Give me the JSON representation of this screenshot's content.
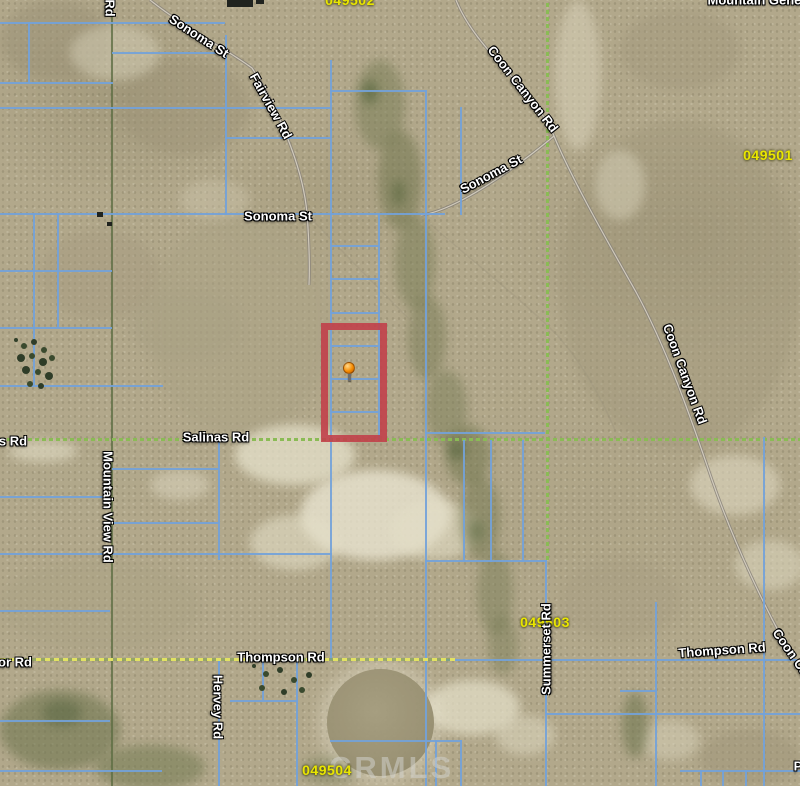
{
  "map": {
    "watermark_text": "CRMLS",
    "colors": {
      "terrain_base": "#b2a88b",
      "parcel_line_blue": "#73a2d9",
      "section_line_green": "#8abb55",
      "road_dash_yellow": "#e2e263",
      "highlight_red": "#c2414b",
      "marker_orange": "#f68b00",
      "parcel_label_yellow": "#e9e600",
      "road_label_white": "#ffffff",
      "watermark_gray": "#d0d0ca"
    }
  },
  "marker": {
    "x": 349,
    "y": 368
  },
  "highlight_parcel": {
    "x": 321,
    "y": 323,
    "w": 66,
    "h": 119
  },
  "labels": [
    {
      "name": "area-label-049502-partial",
      "kind": "parcel",
      "text": "049502",
      "x": 350,
      "y": 0,
      "rot": 0
    },
    {
      "name": "area-label-049501",
      "kind": "parcel",
      "text": "049501",
      "x": 768,
      "y": 155,
      "rot": 0
    },
    {
      "name": "area-label-049503",
      "kind": "parcel",
      "text": "049503",
      "x": 545,
      "y": 622,
      "rot": 0
    },
    {
      "name": "area-label-049504",
      "kind": "parcel",
      "text": "049504",
      "x": 327,
      "y": 770,
      "rot": 0
    },
    {
      "name": "road-label-sonoma-st-nw",
      "kind": "road",
      "text": "Sonoma St",
      "x": 199,
      "y": 36,
      "rot": 33
    },
    {
      "name": "road-label-fairview-rd",
      "kind": "road",
      "text": "Fairview Rd",
      "x": 271,
      "y": 106,
      "rot": 61
    },
    {
      "name": "road-label-coon-canyon-rd-n",
      "kind": "road",
      "text": "Coon Canyon Rd",
      "x": 523,
      "y": 89,
      "rot": 52
    },
    {
      "name": "road-label-sonoma-st-mid",
      "kind": "road",
      "text": "Sonoma St",
      "x": 491,
      "y": 174,
      "rot": -28
    },
    {
      "name": "road-label-sonoma-st-w",
      "kind": "road",
      "text": "Sonoma St",
      "x": 278,
      "y": 216,
      "rot": 0
    },
    {
      "name": "road-label-salinas-rd",
      "kind": "road",
      "text": "Salinas Rd",
      "x": 216,
      "y": 437,
      "rot": 0
    },
    {
      "name": "road-label-mountain-view-rd",
      "kind": "road",
      "text": "Mountain View Rd",
      "x": 108,
      "y": 507,
      "rot": 90
    },
    {
      "name": "road-label-coon-canyon-rd-s",
      "kind": "road",
      "text": "Coon Canyon Rd",
      "x": 685,
      "y": 374,
      "rot": 70
    },
    {
      "name": "road-label-summerset-rd",
      "kind": "road",
      "text": "Summerset Rd",
      "x": 546,
      "y": 649,
      "rot": -90
    },
    {
      "name": "road-label-thompson-rd-w",
      "kind": "road",
      "text": "Thompson Rd",
      "x": 281,
      "y": 657,
      "rot": 0
    },
    {
      "name": "road-label-thompson-rd-e",
      "kind": "road",
      "text": "Thompson Rd",
      "x": 722,
      "y": 650,
      "rot": -4
    },
    {
      "name": "road-label-coon-canyon-rd-se-partial",
      "kind": "road",
      "text": "Coon Ca",
      "x": 791,
      "y": 652,
      "rot": 55
    },
    {
      "name": "road-label-hervey-rd",
      "kind": "road",
      "text": "Hervey Rd",
      "x": 218,
      "y": 707,
      "rot": 90
    },
    {
      "name": "road-label-rd-partial-top",
      "kind": "road",
      "text": "Rd",
      "x": 110,
      "y": 8,
      "rot": 90
    },
    {
      "name": "road-label-s-rd-partial",
      "kind": "road",
      "text": "s Rd",
      "x": 13,
      "y": 441,
      "rot": 0
    },
    {
      "name": "road-label-or-rd-partial",
      "kind": "road",
      "text": "or Rd",
      "x": 15,
      "y": 662,
      "rot": 0
    },
    {
      "name": "road-label-mountain-gener-partial",
      "kind": "road",
      "text": "Mountain Gener",
      "x": 757,
      "y": 0,
      "rot": 0
    },
    {
      "name": "road-label-p-partial",
      "kind": "road",
      "text": "P",
      "x": 798,
      "y": 766,
      "rot": 0
    }
  ],
  "map_lines": [
    {
      "x": 111,
      "y": 0,
      "w": 2,
      "h": 786,
      "t": "olive"
    },
    {
      "x": 0,
      "y": 438,
      "w": 800,
      "h": 3,
      "t": "section"
    },
    {
      "x": 546,
      "y": 0,
      "w": 3,
      "h": 560,
      "t": "section"
    },
    {
      "x": 0,
      "y": 22,
      "w": 225,
      "h": 2
    },
    {
      "x": 112,
      "y": 52,
      "w": 113,
      "h": 2
    },
    {
      "x": 0,
      "y": 82,
      "w": 113,
      "h": 2
    },
    {
      "x": 0,
      "y": 107,
      "w": 330,
      "h": 2
    },
    {
      "x": 225,
      "y": 137,
      "w": 105,
      "h": 2
    },
    {
      "x": 330,
      "y": 90,
      "w": 97,
      "h": 2
    },
    {
      "x": 0,
      "y": 213,
      "w": 445,
      "h": 2
    },
    {
      "x": 0,
      "y": 270,
      "w": 112,
      "h": 2
    },
    {
      "x": 0,
      "y": 327,
      "w": 112,
      "h": 2
    },
    {
      "x": 0,
      "y": 385,
      "w": 163,
      "h": 2
    },
    {
      "x": 330,
      "y": 245,
      "w": 48,
      "h": 2
    },
    {
      "x": 330,
      "y": 278,
      "w": 48,
      "h": 2
    },
    {
      "x": 330,
      "y": 312,
      "w": 48,
      "h": 2
    },
    {
      "x": 330,
      "y": 345,
      "w": 48,
      "h": 2
    },
    {
      "x": 330,
      "y": 378,
      "w": 48,
      "h": 2
    },
    {
      "x": 330,
      "y": 411,
      "w": 48,
      "h": 2
    },
    {
      "x": 0,
      "y": 496,
      "w": 110,
      "h": 2
    },
    {
      "x": 112,
      "y": 468,
      "w": 106,
      "h": 2
    },
    {
      "x": 112,
      "y": 522,
      "w": 106,
      "h": 2
    },
    {
      "x": 0,
      "y": 553,
      "w": 332,
      "h": 2
    },
    {
      "x": 0,
      "y": 610,
      "w": 110,
      "h": 2
    },
    {
      "x": 425,
      "y": 432,
      "w": 120,
      "h": 2
    },
    {
      "x": 425,
      "y": 560,
      "w": 122,
      "h": 2
    },
    {
      "x": 440,
      "y": 659,
      "w": 360,
      "h": 2
    },
    {
      "x": 0,
      "y": 720,
      "w": 110,
      "h": 2
    },
    {
      "x": 230,
      "y": 700,
      "w": 68,
      "h": 2
    },
    {
      "x": 545,
      "y": 713,
      "w": 255,
      "h": 2
    },
    {
      "x": 620,
      "y": 690,
      "w": 37,
      "h": 2
    },
    {
      "x": 680,
      "y": 770,
      "w": 120,
      "h": 2
    },
    {
      "x": 0,
      "y": 770,
      "w": 162,
      "h": 2
    },
    {
      "x": 330,
      "y": 740,
      "w": 132,
      "h": 2
    },
    {
      "x": 28,
      "y": 22,
      "w": 2,
      "h": 60
    },
    {
      "x": 33,
      "y": 213,
      "w": 2,
      "h": 172
    },
    {
      "x": 57,
      "y": 213,
      "w": 2,
      "h": 114
    },
    {
      "x": 225,
      "y": 35,
      "w": 2,
      "h": 180
    },
    {
      "x": 330,
      "y": 60,
      "w": 2,
      "h": 600
    },
    {
      "x": 378,
      "y": 213,
      "w": 2,
      "h": 227
    },
    {
      "x": 425,
      "y": 90,
      "w": 2,
      "h": 696
    },
    {
      "x": 460,
      "y": 107,
      "w": 2,
      "h": 108
    },
    {
      "x": 463,
      "y": 440,
      "w": 2,
      "h": 122
    },
    {
      "x": 490,
      "y": 440,
      "w": 2,
      "h": 122
    },
    {
      "x": 522,
      "y": 440,
      "w": 2,
      "h": 122
    },
    {
      "x": 545,
      "y": 560,
      "w": 2,
      "h": 226
    },
    {
      "x": 655,
      "y": 602,
      "w": 2,
      "h": 184
    },
    {
      "x": 763,
      "y": 437,
      "w": 2,
      "h": 349
    },
    {
      "x": 296,
      "y": 660,
      "w": 2,
      "h": 126
    },
    {
      "x": 218,
      "y": 440,
      "w": 2,
      "h": 120
    },
    {
      "x": 218,
      "y": 658,
      "w": 2,
      "h": 128
    },
    {
      "x": 700,
      "y": 770,
      "w": 2,
      "h": 16
    },
    {
      "x": 722,
      "y": 770,
      "w": 2,
      "h": 16
    },
    {
      "x": 745,
      "y": 770,
      "w": 2,
      "h": 16
    },
    {
      "x": 435,
      "y": 740,
      "w": 2,
      "h": 46
    },
    {
      "x": 460,
      "y": 740,
      "w": 2,
      "h": 46
    },
    {
      "x": 262,
      "y": 660,
      "w": 2,
      "h": 40
    },
    {
      "x": 0,
      "y": 658,
      "w": 455,
      "h": 3,
      "t": "roaddash"
    }
  ]
}
